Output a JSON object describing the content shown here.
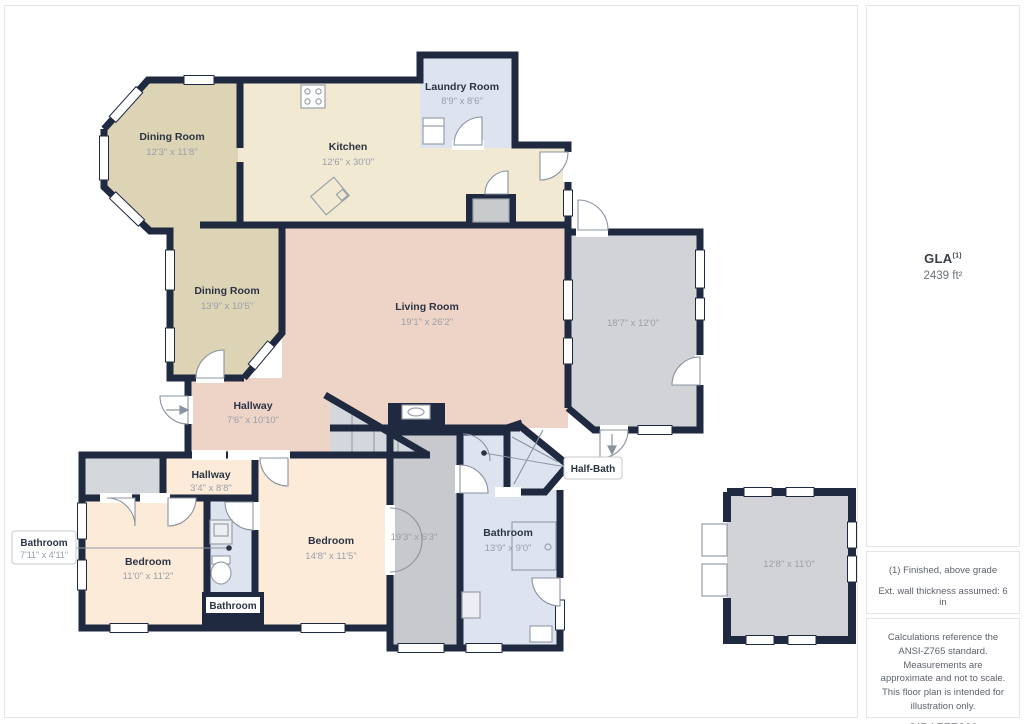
{
  "floorplan": {
    "rooms": {
      "dining1": {
        "name": "Dining Room",
        "dims": "12'3\" x 11'8\""
      },
      "kitchen": {
        "name": "Kitchen",
        "dims": "12'6\" x 30'0\""
      },
      "laundry": {
        "name": "Laundry Room",
        "dims": "8'9\" x 8'6\""
      },
      "dining2": {
        "name": "Dining Room",
        "dims": "13'9\" x 10'5\""
      },
      "living": {
        "name": "Living Room",
        "dims": "19'1\" x 26'2\""
      },
      "garage": {
        "dims": "18'7\" x 12'0\""
      },
      "hallway1": {
        "name": "Hallway",
        "dims": "7'6\" x 10'10\""
      },
      "hallway2": {
        "name": "Hallway",
        "dims": "3'4\" x 8'8\""
      },
      "bedroom1": {
        "name": "Bedroom",
        "dims": "11'0\" x 11'2\""
      },
      "bedroom2": {
        "name": "Bedroom",
        "dims": "14'8\" x 11'5\""
      },
      "corridor": {
        "dims": "19'3\" x 6'3\""
      },
      "bathroom_main": {
        "name": "Bathroom",
        "dims": "13'9\" x 9'0\""
      },
      "bathroom_small": {
        "name": "Bathroom"
      },
      "bathroom_callout": {
        "name": "Bathroom",
        "dims": "7'11\" x 4'11\""
      },
      "halfbath": {
        "name": "Half-Bath"
      },
      "outbuilding": {
        "dims": "12'8\" x 11'0\""
      }
    },
    "colors": {
      "wall": "#1f2940",
      "dining": "#ddd3b5",
      "kitchen": "#f1e9d2",
      "living": "#eed4c7",
      "bedroom": "#fdebd9",
      "bathroom": "#dde3ef",
      "garage": "#d2d3d6"
    }
  },
  "sidebar": {
    "gla_label": "GLA",
    "gla_sup": "(1)",
    "gla_value": "2439 ft²",
    "note_finished": "(1) Finished, above grade",
    "note_wall": "Ext. wall thickness assumed: 6 in",
    "disclaimer": "Calculations reference the ANSI-Z765 standard. Measurements are approximate and not to scale. This floor plan is intended for illustration only.",
    "brand_name": "GIRAFFE",
    "brand_number": "360"
  }
}
